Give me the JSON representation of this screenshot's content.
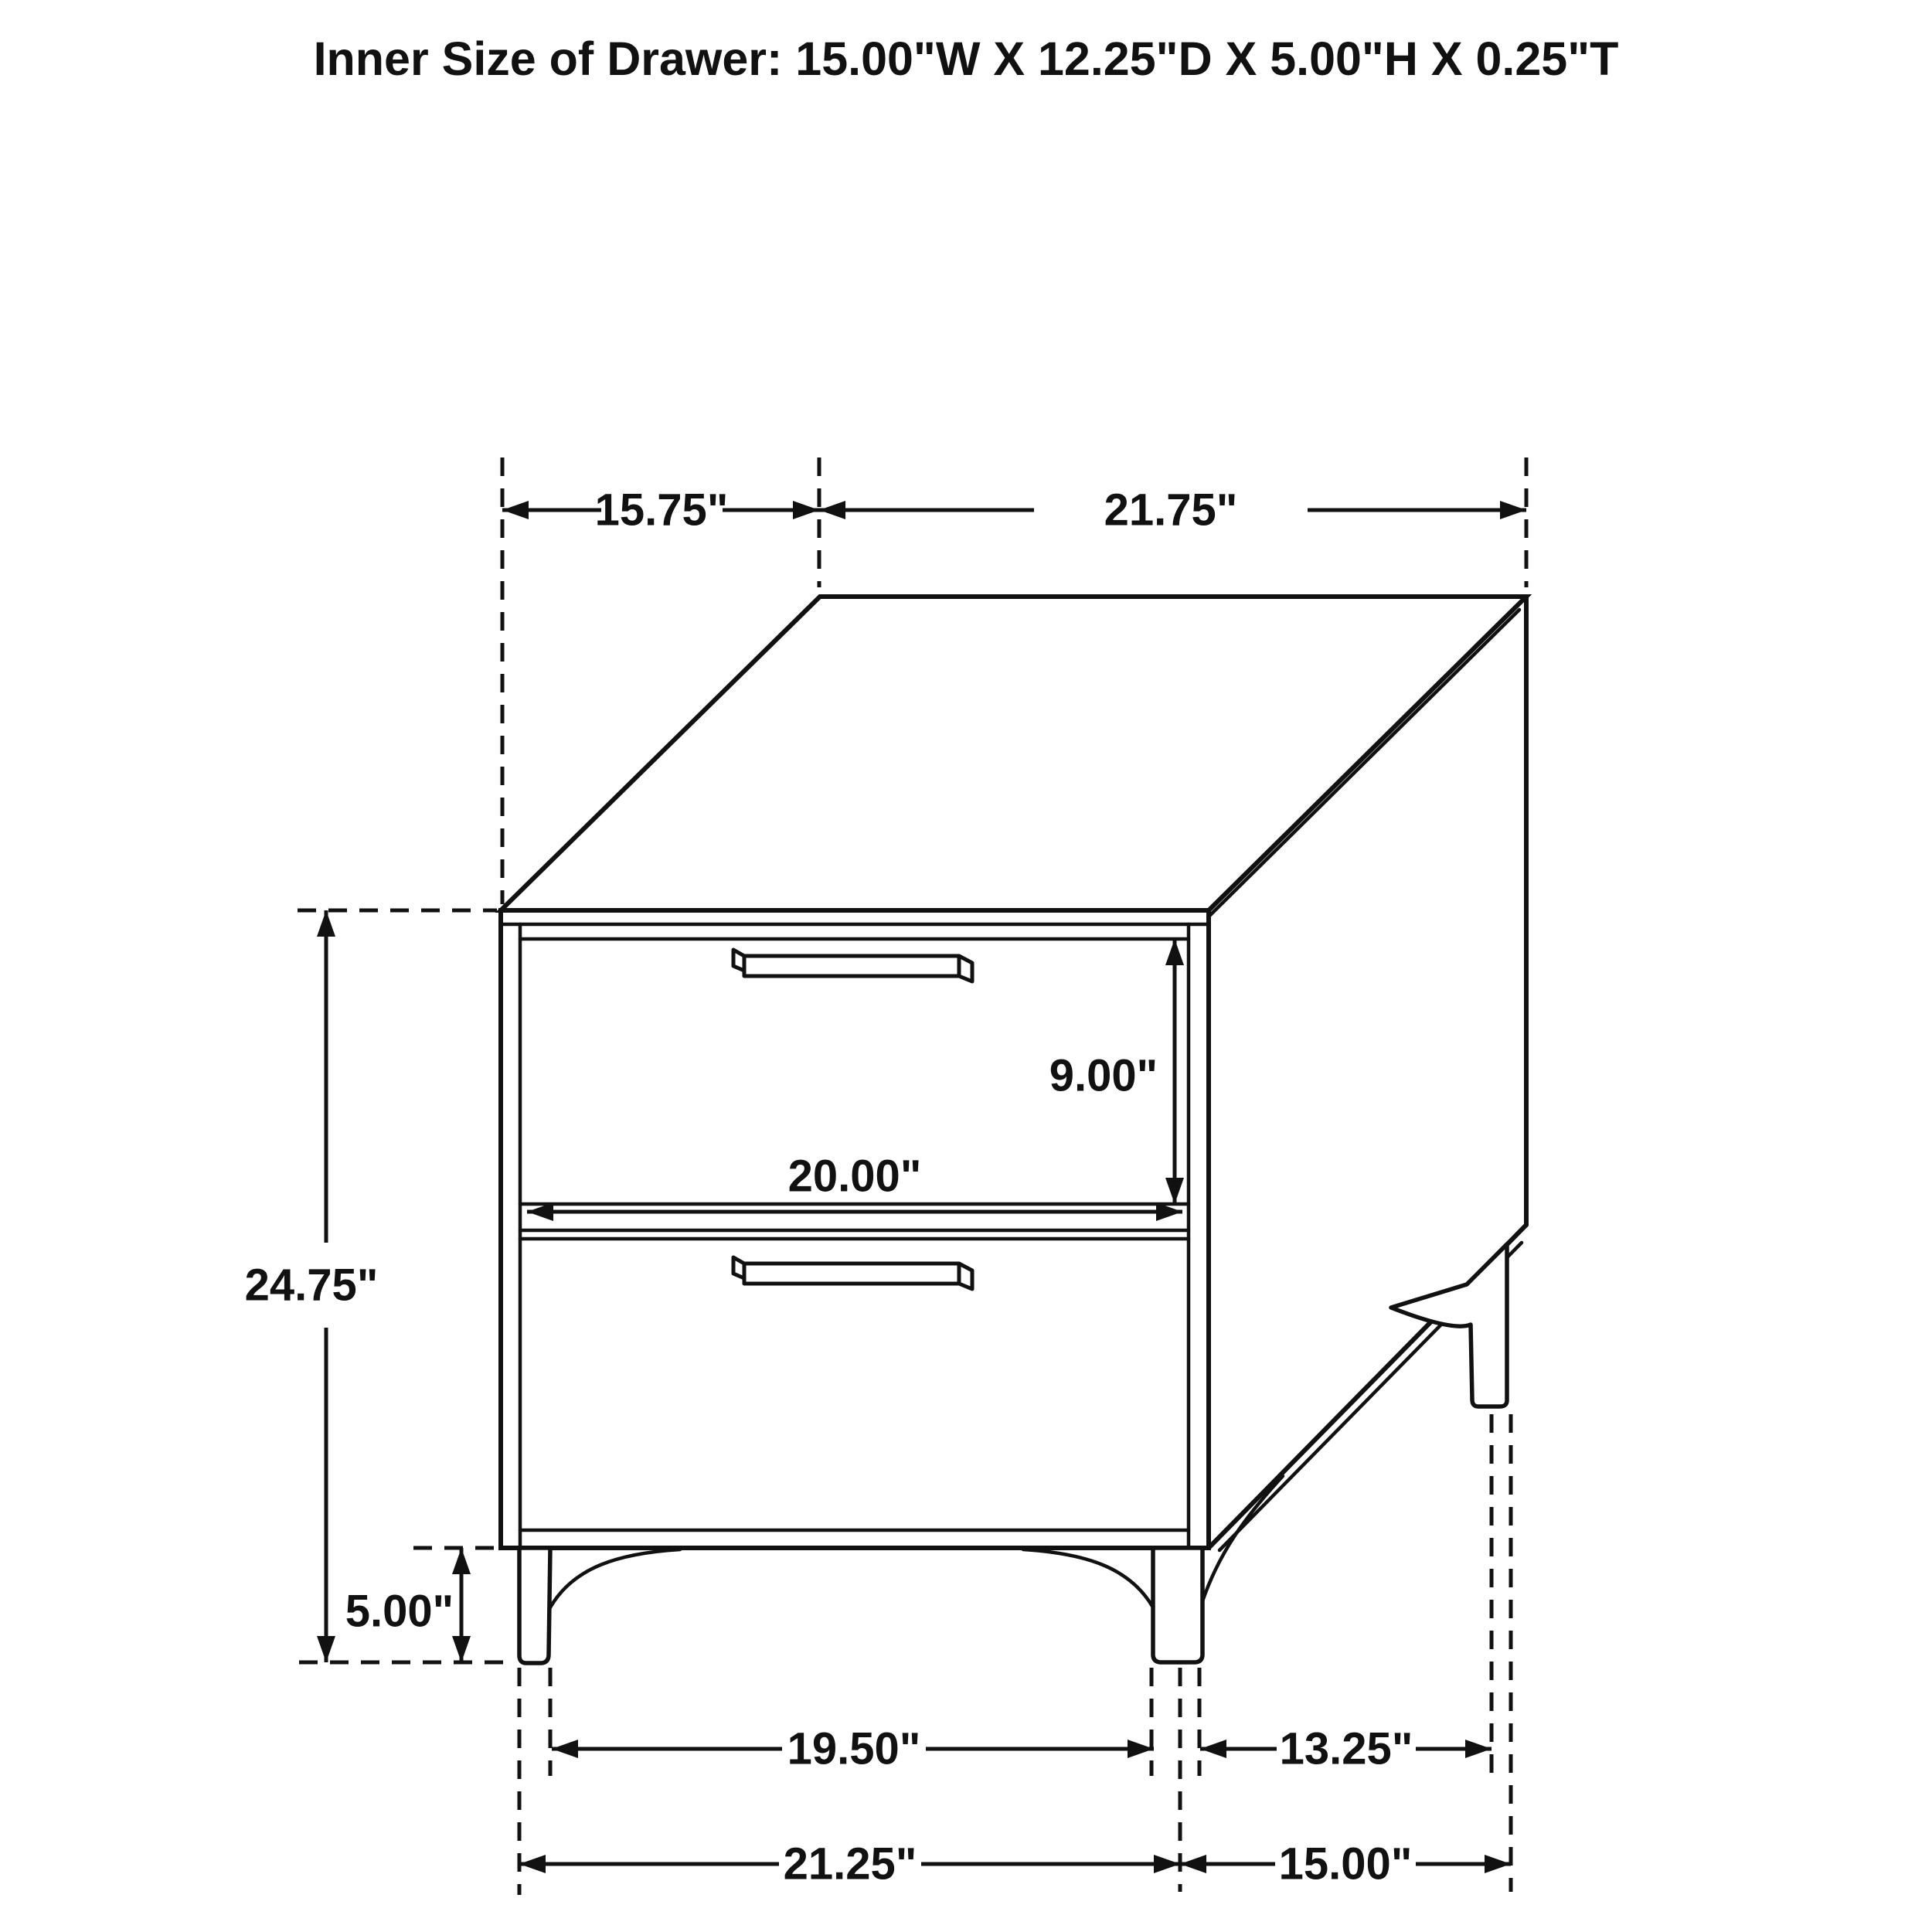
{
  "title": "Inner Size of Drawer: 15.00\"W X 12.25\"D X 5.00\"H X 0.25\"T",
  "dimensions": {
    "top_depth": "15.75\"",
    "top_width": "21.75\"",
    "overall_height": "24.75\"",
    "drawer_front_height": "9.00\"",
    "drawer_front_width": "20.00\"",
    "leg_height": "5.00\"",
    "front_leg_inner_span": "19.50\"",
    "side_leg_span": "13.25\"",
    "front_outer_width": "21.25\"",
    "side_outer_depth": "15.00\""
  }
}
